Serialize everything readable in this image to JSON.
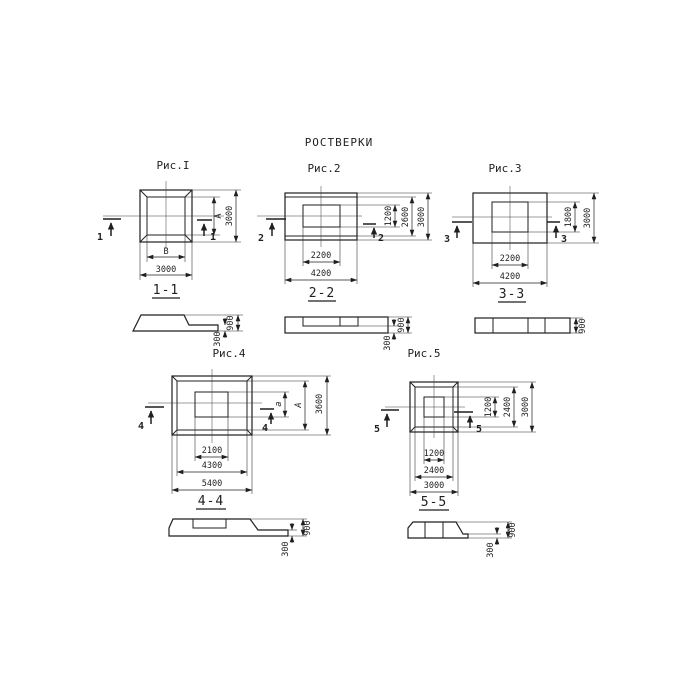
{
  "title": "РОСТВЕРКИ",
  "colors": {
    "ink": "#1f1f1f",
    "background": "#ffffff"
  },
  "figures": {
    "fig1": {
      "caption": "Рис.I",
      "cut_mark": "1",
      "plan_dims": {
        "right_inner": "А",
        "right_outer": "3000",
        "bottom_inner": "В",
        "bottom_outer": "3000"
      },
      "section": {
        "label": "1-1",
        "ledge_height": "300",
        "total_height": "900"
      }
    },
    "fig2": {
      "caption": "Рис.2",
      "cut_mark": "2",
      "plan_dims": {
        "right_inner": "1200",
        "right_mid": "2600",
        "right_outer": "3000",
        "bottom_inner": "2200",
        "bottom_outer": "4200"
      },
      "section": {
        "label": "2-2",
        "ledge_height": "300",
        "total_height": "900"
      }
    },
    "fig3": {
      "caption": "Рис.3",
      "cut_mark": "3",
      "plan_dims": {
        "right_inner": "1800",
        "right_outer": "3000",
        "bottom_inner": "2200",
        "bottom_outer": "4200"
      },
      "section": {
        "label": "3-3",
        "total_height": "900"
      }
    },
    "fig4": {
      "caption": "Рис.4",
      "cut_mark": "4",
      "plan_dims": {
        "right_inner": "а",
        "right_mid": "А",
        "right_outer": "3600",
        "bottom_inner": "2100",
        "bottom_mid": "4300",
        "bottom_outer": "5400"
      },
      "section": {
        "label": "4-4",
        "ledge_height": "300",
        "total_height": "900"
      }
    },
    "fig5": {
      "caption": "Рис.5",
      "cut_mark": "5",
      "plan_dims": {
        "right_inner": "1200",
        "right_mid": "2400",
        "right_outer": "3000",
        "bottom_inner": "1200",
        "bottom_mid": "2400",
        "bottom_outer": "3000"
      },
      "section": {
        "label": "5-5",
        "ledge_height": "300",
        "total_height": "900"
      }
    }
  }
}
